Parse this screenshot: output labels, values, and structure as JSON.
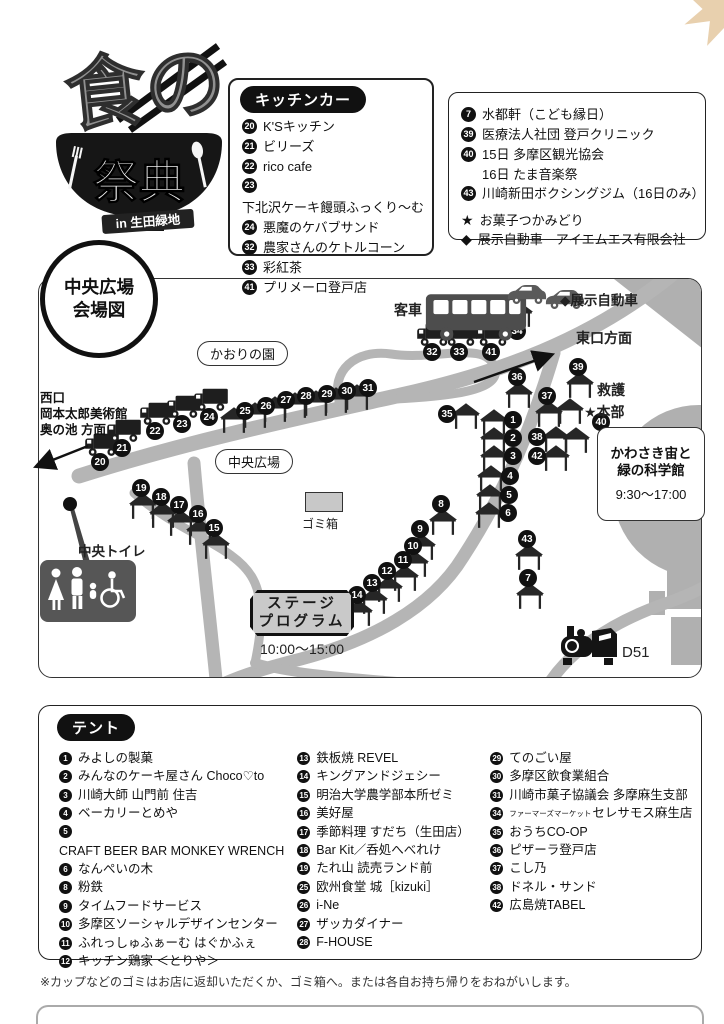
{
  "logo": {
    "title_top": "食の",
    "title_main": "祭典",
    "subtitle": "in 生田緑地"
  },
  "kitchen_box": {
    "title": "キッチンカー",
    "items": [
      {
        "n": "20",
        "label": "K'Sキッチン"
      },
      {
        "n": "21",
        "label": "ビリーズ"
      },
      {
        "n": "22",
        "label": "rico cafe"
      },
      {
        "n": "23",
        "label": "下北沢ケーキ饅頭ふっくり〜む"
      },
      {
        "n": "24",
        "label": "悪魔のケバブサンド"
      },
      {
        "n": "32",
        "label": "農家さんのケトルコーン"
      },
      {
        "n": "33",
        "label": "彩紅茶"
      },
      {
        "n": "41",
        "label": "プリメーロ登戸店"
      }
    ]
  },
  "info_box": {
    "items": [
      {
        "n": "7",
        "label": "水都軒（こども縁日）"
      },
      {
        "n": "39",
        "label": "医療法人社団 登戸クリニック"
      },
      {
        "n": "40",
        "label": "15日  多摩区観光協会",
        "label2": "16日  たま音楽祭"
      },
      {
        "n": "43",
        "label": "川崎新田ボクシングジム（16日のみ）"
      }
    ],
    "notes": [
      {
        "mark": "★",
        "label": "お菓子つかみどり"
      },
      {
        "mark": "◆",
        "label": "展示自動車　アイエムエス有限会社"
      }
    ]
  },
  "map": {
    "badge_line1": "中央広場",
    "badge_line2": "会場図",
    "labels": {
      "passenger_car": "客車",
      "exhibit_car": "◆展示自動車",
      "east_exit": "東口方面",
      "first_aid": "救護",
      "hq": "★本部",
      "science_museum": [
        "かわさき宙と",
        "緑の科学館",
        "9:30〜17:00"
      ],
      "kaori_garden": "かおりの園",
      "west_exit": [
        "西口",
        "岡本太郎美術館",
        "奥の池 方面"
      ],
      "central_plaza": "中央広場",
      "trash": "ゴミ箱",
      "central_toilet": "中央トイレ",
      "stage": [
        "ステージ",
        "プログラム"
      ],
      "stage_time": "10:00〜15:00",
      "d51": "D51"
    },
    "markers": [
      {
        "n": "20",
        "x": 100,
        "y": 462,
        "icon": "truck",
        "ipos": "above"
      },
      {
        "n": "21",
        "x": 122,
        "y": 448,
        "icon": "truck",
        "ipos": "above"
      },
      {
        "n": "22",
        "x": 155,
        "y": 431,
        "icon": "truck",
        "ipos": "above"
      },
      {
        "n": "23",
        "x": 182,
        "y": 424,
        "icon": "truck",
        "ipos": "above"
      },
      {
        "n": "24",
        "x": 209,
        "y": 417,
        "icon": "truck",
        "ipos": "above"
      },
      {
        "n": "25",
        "x": 245,
        "y": 411,
        "icon": "tent",
        "ipos": "belowleft"
      },
      {
        "n": "26",
        "x": 266,
        "y": 406,
        "icon": "tent",
        "ipos": "belowleft"
      },
      {
        "n": "27",
        "x": 286,
        "y": 400,
        "icon": "tent",
        "ipos": "belowleft"
      },
      {
        "n": "28",
        "x": 306,
        "y": 396,
        "icon": "tent",
        "ipos": "belowleft"
      },
      {
        "n": "29",
        "x": 327,
        "y": 394,
        "icon": "tent",
        "ipos": "belowleft"
      },
      {
        "n": "30",
        "x": 347,
        "y": 391,
        "icon": "tent",
        "ipos": "belowleft"
      },
      {
        "n": "31",
        "x": 368,
        "y": 388,
        "icon": "tent",
        "ipos": "belowleft"
      },
      {
        "n": "32",
        "x": 432,
        "y": 352,
        "icon": "truck",
        "ipos": "above"
      },
      {
        "n": "33",
        "x": 459,
        "y": 352,
        "icon": "truck",
        "ipos": "above"
      },
      {
        "n": "41",
        "x": 491,
        "y": 352,
        "icon": "truck",
        "ipos": "above"
      },
      {
        "n": "34",
        "x": 517,
        "y": 331,
        "icon": "tent",
        "ipos": "above"
      },
      {
        "n": "36",
        "x": 517,
        "y": 377,
        "icon": "tent",
        "ipos": "below"
      },
      {
        "n": "39",
        "x": 578,
        "y": 367,
        "icon": "tent",
        "ipos": "below"
      },
      {
        "n": "37",
        "x": 547,
        "y": 396,
        "icon": "tent",
        "ipos": "below"
      },
      {
        "n": "",
        "x": 570,
        "y": 411,
        "icon": "tent",
        "ipos": "center"
      },
      {
        "n": "40",
        "x": 601,
        "y": 422,
        "icon": "",
        "ipos": ""
      },
      {
        "n": "",
        "x": 576,
        "y": 440,
        "icon": "tent",
        "ipos": "center"
      },
      {
        "n": "1",
        "x": 513,
        "y": 420,
        "icon": "tent",
        "ipos": "left"
      },
      {
        "n": "2",
        "x": 513,
        "y": 438,
        "icon": "tent",
        "ipos": "left"
      },
      {
        "n": "3",
        "x": 513,
        "y": 456,
        "icon": "tent",
        "ipos": "left"
      },
      {
        "n": "4",
        "x": 510,
        "y": 476,
        "icon": "tent",
        "ipos": "left"
      },
      {
        "n": "5",
        "x": 509,
        "y": 495,
        "icon": "tent",
        "ipos": "left"
      },
      {
        "n": "6",
        "x": 508,
        "y": 513,
        "icon": "tent",
        "ipos": "left"
      },
      {
        "n": "38",
        "x": 537,
        "y": 437,
        "icon": "tent",
        "ipos": "right"
      },
      {
        "n": "42",
        "x": 537,
        "y": 456,
        "icon": "tent",
        "ipos": "right"
      },
      {
        "n": "35",
        "x": 447,
        "y": 414,
        "icon": "tent",
        "ipos": "right"
      },
      {
        "n": "8",
        "x": 441,
        "y": 504,
        "icon": "tent",
        "ipos": "below"
      },
      {
        "n": "9",
        "x": 420,
        "y": 529,
        "icon": "tent",
        "ipos": "below"
      },
      {
        "n": "10",
        "x": 413,
        "y": 546,
        "icon": "tent",
        "ipos": "below"
      },
      {
        "n": "11",
        "x": 403,
        "y": 560,
        "icon": "tent",
        "ipos": "below"
      },
      {
        "n": "12",
        "x": 387,
        "y": 571,
        "icon": "tent",
        "ipos": "below"
      },
      {
        "n": "13",
        "x": 372,
        "y": 583,
        "icon": "tent",
        "ipos": "below"
      },
      {
        "n": "14",
        "x": 357,
        "y": 595,
        "icon": "tent",
        "ipos": "below"
      },
      {
        "n": "15",
        "x": 214,
        "y": 528,
        "icon": "tent",
        "ipos": "below"
      },
      {
        "n": "16",
        "x": 198,
        "y": 514,
        "icon": "tent",
        "ipos": "below"
      },
      {
        "n": "17",
        "x": 179,
        "y": 505,
        "icon": "tent",
        "ipos": "below"
      },
      {
        "n": "18",
        "x": 161,
        "y": 497,
        "icon": "tent",
        "ipos": "below"
      },
      {
        "n": "19",
        "x": 141,
        "y": 488,
        "icon": "tent",
        "ipos": "below"
      },
      {
        "n": "43",
        "x": 527,
        "y": 539,
        "icon": "tent",
        "ipos": "below"
      },
      {
        "n": "7",
        "x": 528,
        "y": 578,
        "icon": "tent",
        "ipos": "below"
      }
    ]
  },
  "tent_box": {
    "title": "テント",
    "columns": [
      [
        {
          "n": "1",
          "label": "みよしの製菓"
        },
        {
          "n": "2",
          "label": "みんなのケーキ屋さん Choco♡to"
        },
        {
          "n": "3",
          "label": "川崎大師 山門前 住吉"
        },
        {
          "n": "4",
          "label": "ベーカリーとめや"
        },
        {
          "n": "5",
          "label": "CRAFT BEER BAR MONKEY WRENCH"
        },
        {
          "n": "6",
          "label": "なんぺいの木"
        },
        {
          "n": "8",
          "label": "粉鉄"
        },
        {
          "n": "9",
          "label": "タイムフードサービス"
        },
        {
          "n": "10",
          "label": "多摩区ソーシャルデザインセンター"
        },
        {
          "n": "11",
          "label": "ふれっしゅふぁーむ はぐかふぇ"
        },
        {
          "n": "12",
          "label": "キッチン鶏家 ＜とりや＞"
        }
      ],
      [
        {
          "n": "13",
          "label": "鉄板焼 REVEL"
        },
        {
          "n": "14",
          "label": "キングアンドジェシー"
        },
        {
          "n": "15",
          "label": "明治大学農学部本所ゼミ"
        },
        {
          "n": "16",
          "label": "美好屋"
        },
        {
          "n": "17",
          "label": "季節料理 すだち（生田店）"
        },
        {
          "n": "18",
          "label": "Bar Kit／呑処へべれけ"
        },
        {
          "n": "19",
          "label": "たれ山 読売ランド前"
        },
        {
          "n": "25",
          "label": "欧州食堂 城［kizuki］"
        },
        {
          "n": "26",
          "label": "i-Ne"
        },
        {
          "n": "27",
          "label": "ザッカダイナー"
        },
        {
          "n": "28",
          "label": "F-HOUSE"
        }
      ],
      [
        {
          "n": "29",
          "label": "てのごい屋"
        },
        {
          "n": "30",
          "label": "多摩区飲食業組合"
        },
        {
          "n": "31",
          "label": "川崎市菓子協議会 多摩麻生支部"
        },
        {
          "n": "34",
          "small": "ファーマーズマーケット",
          "label": "セレサモス麻生店"
        },
        {
          "n": "35",
          "label": "おうちCO-OP"
        },
        {
          "n": "36",
          "label": "ピザーラ登戸店"
        },
        {
          "n": "37",
          "label": "こし乃"
        },
        {
          "n": "38",
          "label": "ドネル・サンド"
        },
        {
          "n": "42",
          "label": "広島焼TABEL"
        }
      ]
    ]
  },
  "footer_note": "※カップなどのゴミはお店に返却いただくか、ゴミ箱へ。または各自お持ち帰りをおねがいします。",
  "decor": {
    "leaves": [
      {
        "x": 432,
        "y": 66,
        "s": 26,
        "r": -20,
        "c": "#e6cba6",
        "o": 0.9
      },
      {
        "x": 458,
        "y": 58,
        "s": 34,
        "r": 10,
        "c": "#cf9352",
        "o": 1
      },
      {
        "x": 492,
        "y": 52,
        "s": 40,
        "r": -5,
        "c": "#ecd9bd",
        "o": 0.9
      },
      {
        "x": 520,
        "y": 60,
        "s": 34,
        "r": 20,
        "c": "#cf9352",
        "o": 1
      },
      {
        "x": 552,
        "y": 50,
        "s": 38,
        "r": -15,
        "c": "#ecd9bd",
        "o": 0.95
      },
      {
        "x": 576,
        "y": 62,
        "s": 30,
        "r": 25,
        "c": "#d49b5c",
        "o": 1
      },
      {
        "x": 604,
        "y": 46,
        "s": 40,
        "r": 0,
        "c": "#eedec6",
        "o": 0.95
      },
      {
        "x": 628,
        "y": 64,
        "s": 24,
        "r": -30,
        "c": "#d49b5c",
        "o": 1
      },
      {
        "x": 656,
        "y": 50,
        "s": 38,
        "r": 15,
        "c": "#e8cba1",
        "o": 0.95
      },
      {
        "x": 678,
        "y": 68,
        "s": 30,
        "r": -10,
        "c": "#cf9352",
        "o": 1
      },
      {
        "x": 702,
        "y": 58,
        "s": 26,
        "r": 30,
        "c": "#e8cba1",
        "o": 0.9
      }
    ]
  },
  "colors": {
    "road": "#b5b5b5",
    "building": "#b0b0b0",
    "marker": "#111111",
    "leaf_accent": "#cf9352"
  }
}
